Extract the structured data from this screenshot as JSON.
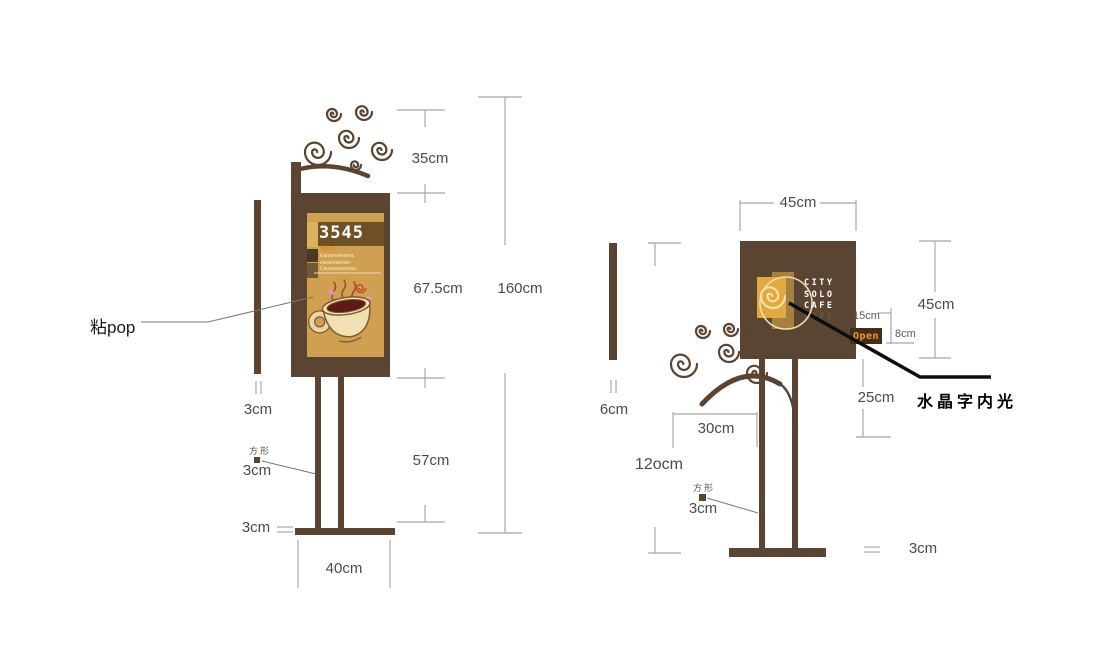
{
  "left_sign": {
    "pop_label": "粘pop",
    "poster": {
      "number": "3545",
      "open_text": "Open",
      "body_lines": [
        "Earaenaeraera,",
        "earaenaeraer.",
        "Caneiaeiaeiaeia."
      ]
    },
    "dims": {
      "top_decoration": "35cm",
      "board_height": "67.5cm",
      "total_height": "160cm",
      "pole_height": "57cm",
      "base_width": "40cm",
      "side_strip": "3cm",
      "shape_label": "方形",
      "pole_square": "3cm",
      "base_thickness": "3cm"
    }
  },
  "right_sign": {
    "logo": {
      "line1": "CITY",
      "line2": "SOLO",
      "line3": "CAFE",
      "ghost": "CAFE"
    },
    "open_sign": "Open",
    "crystal_note": "水晶字内光",
    "dims": {
      "board_width": "45cm",
      "board_height": "45cm",
      "open_offset": "15cm",
      "open_height": "8cm",
      "below_board": "25cm",
      "swirl_offset": "30cm",
      "pole_height": "12ocm",
      "side_strip": "6cm",
      "shape_label": "方形",
      "pole_square": "3cm",
      "base_thickness": "3cm"
    }
  },
  "colors": {
    "sign_brown": "#5a4533",
    "poster_gold": "#cfa050",
    "accent_orange": "#e08b28",
    "logo_gold": "#e2aa3f"
  }
}
